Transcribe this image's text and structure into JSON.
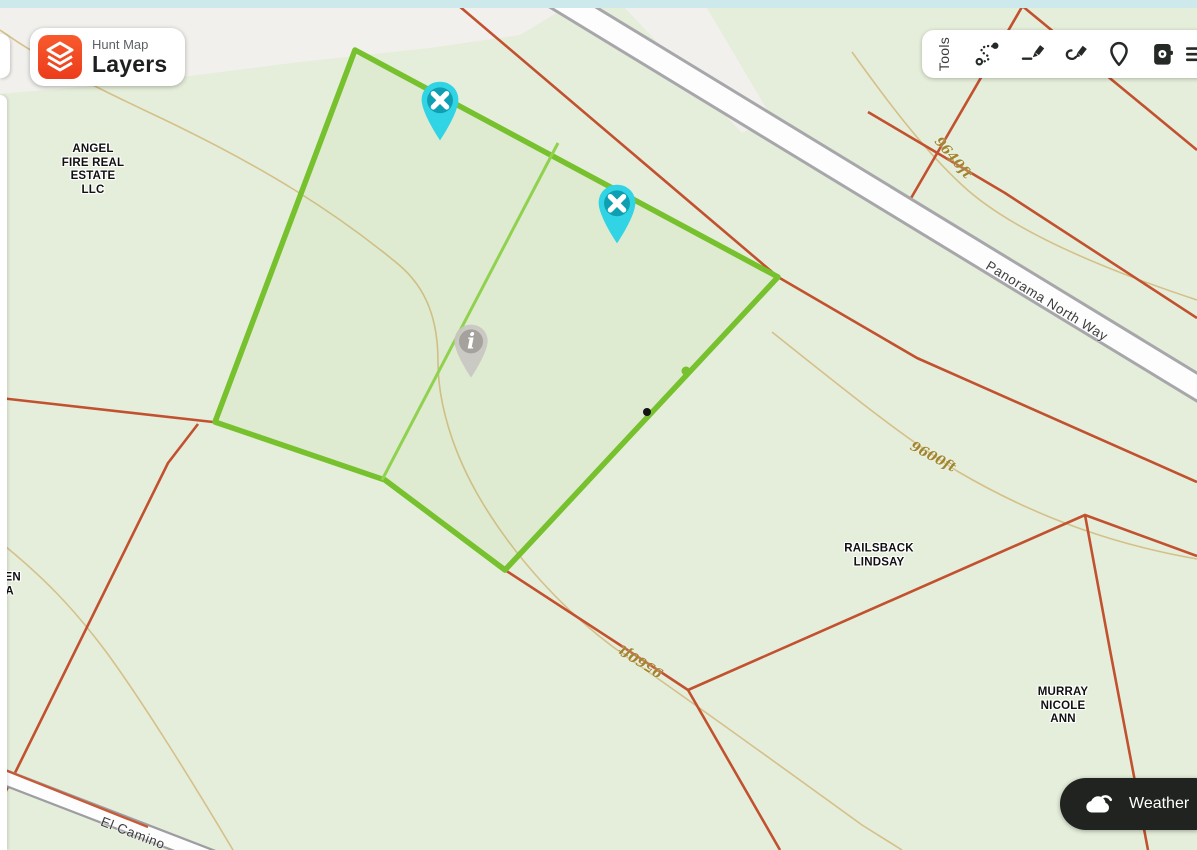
{
  "header": {
    "app_title_small": "Hunt Map",
    "app_title_big": "Layers"
  },
  "toolbar": {
    "label": "Tools",
    "icons": [
      {
        "name": "route-draw-icon"
      },
      {
        "name": "draw-line-icon"
      },
      {
        "name": "draw-shape-icon"
      },
      {
        "name": "pin-icon"
      },
      {
        "name": "trail-camera-icon"
      },
      {
        "name": "menu-icon"
      }
    ]
  },
  "weather": {
    "label": "Weather"
  },
  "map": {
    "owner_labels": [
      {
        "id": "angel-fire",
        "lines": [
          "ANGEL",
          "FIRE REAL",
          "ESTATE",
          "LLC"
        ]
      },
      {
        "id": "railsback",
        "lines": [
          "RAILSBACK",
          "LINDSAY"
        ]
      },
      {
        "id": "murray",
        "lines": [
          "MURRAY",
          "NICOLE",
          "ANN"
        ]
      },
      {
        "id": "clipped-left-edge",
        "lines": [
          "DEN",
          "A"
        ]
      }
    ],
    "road_labels": [
      {
        "name": "Panorama North Way"
      },
      {
        "name": "El Camino"
      }
    ],
    "contour_labels": [
      {
        "text": "9640ft"
      },
      {
        "text": "9600ft"
      },
      {
        "text": "9560ft"
      }
    ],
    "info_marker_glyph": "i"
  },
  "colors": {
    "boundary_green": "#76c12d",
    "divider_green": "#90d24f",
    "marker_cyan": "#31d4e5",
    "marker_inner_teal": "#0e9fb2",
    "info_marker_gray": "#c9c6c2",
    "parcel_line_red": "#c1512f",
    "contour_tan": "#d5c08a",
    "contour_label": "#a1862f",
    "brand_orange": "#f4431f",
    "weather_bg": "#20231f",
    "top_strip": "#cde9ec"
  }
}
